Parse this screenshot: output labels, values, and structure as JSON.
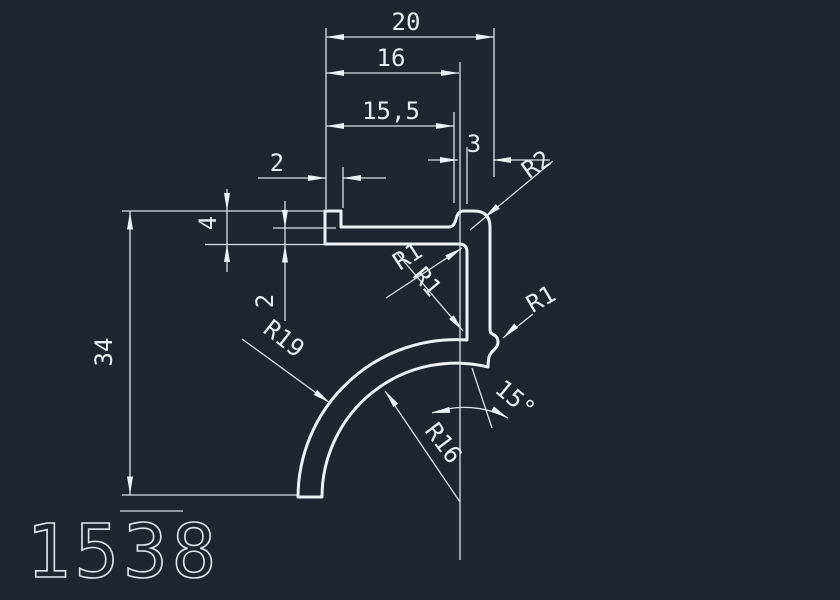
{
  "app": {
    "background_color": "#1f2531",
    "profile_line_color": "#edf1f5",
    "dimension_line_color": "#dbe1e8",
    "text_color": "#e9eef3"
  },
  "drawing": {
    "part_number": "1538",
    "linear_dimensions": {
      "overall_width": "20",
      "width_to_step": "16",
      "shelf_width": "15,5",
      "boss_width": "3",
      "lip_width": "2",
      "left_end_height": "4",
      "flange_thickness": "2",
      "overall_height": "34"
    },
    "radius_dimensions": {
      "top_corner": "R2",
      "inner_fillet_upper": "R1",
      "inner_fillet_lower": "R1",
      "stem_bump": "R1",
      "tail_outer": "R19",
      "tail_inner": "R16"
    },
    "angle_dimension": "15°"
  }
}
